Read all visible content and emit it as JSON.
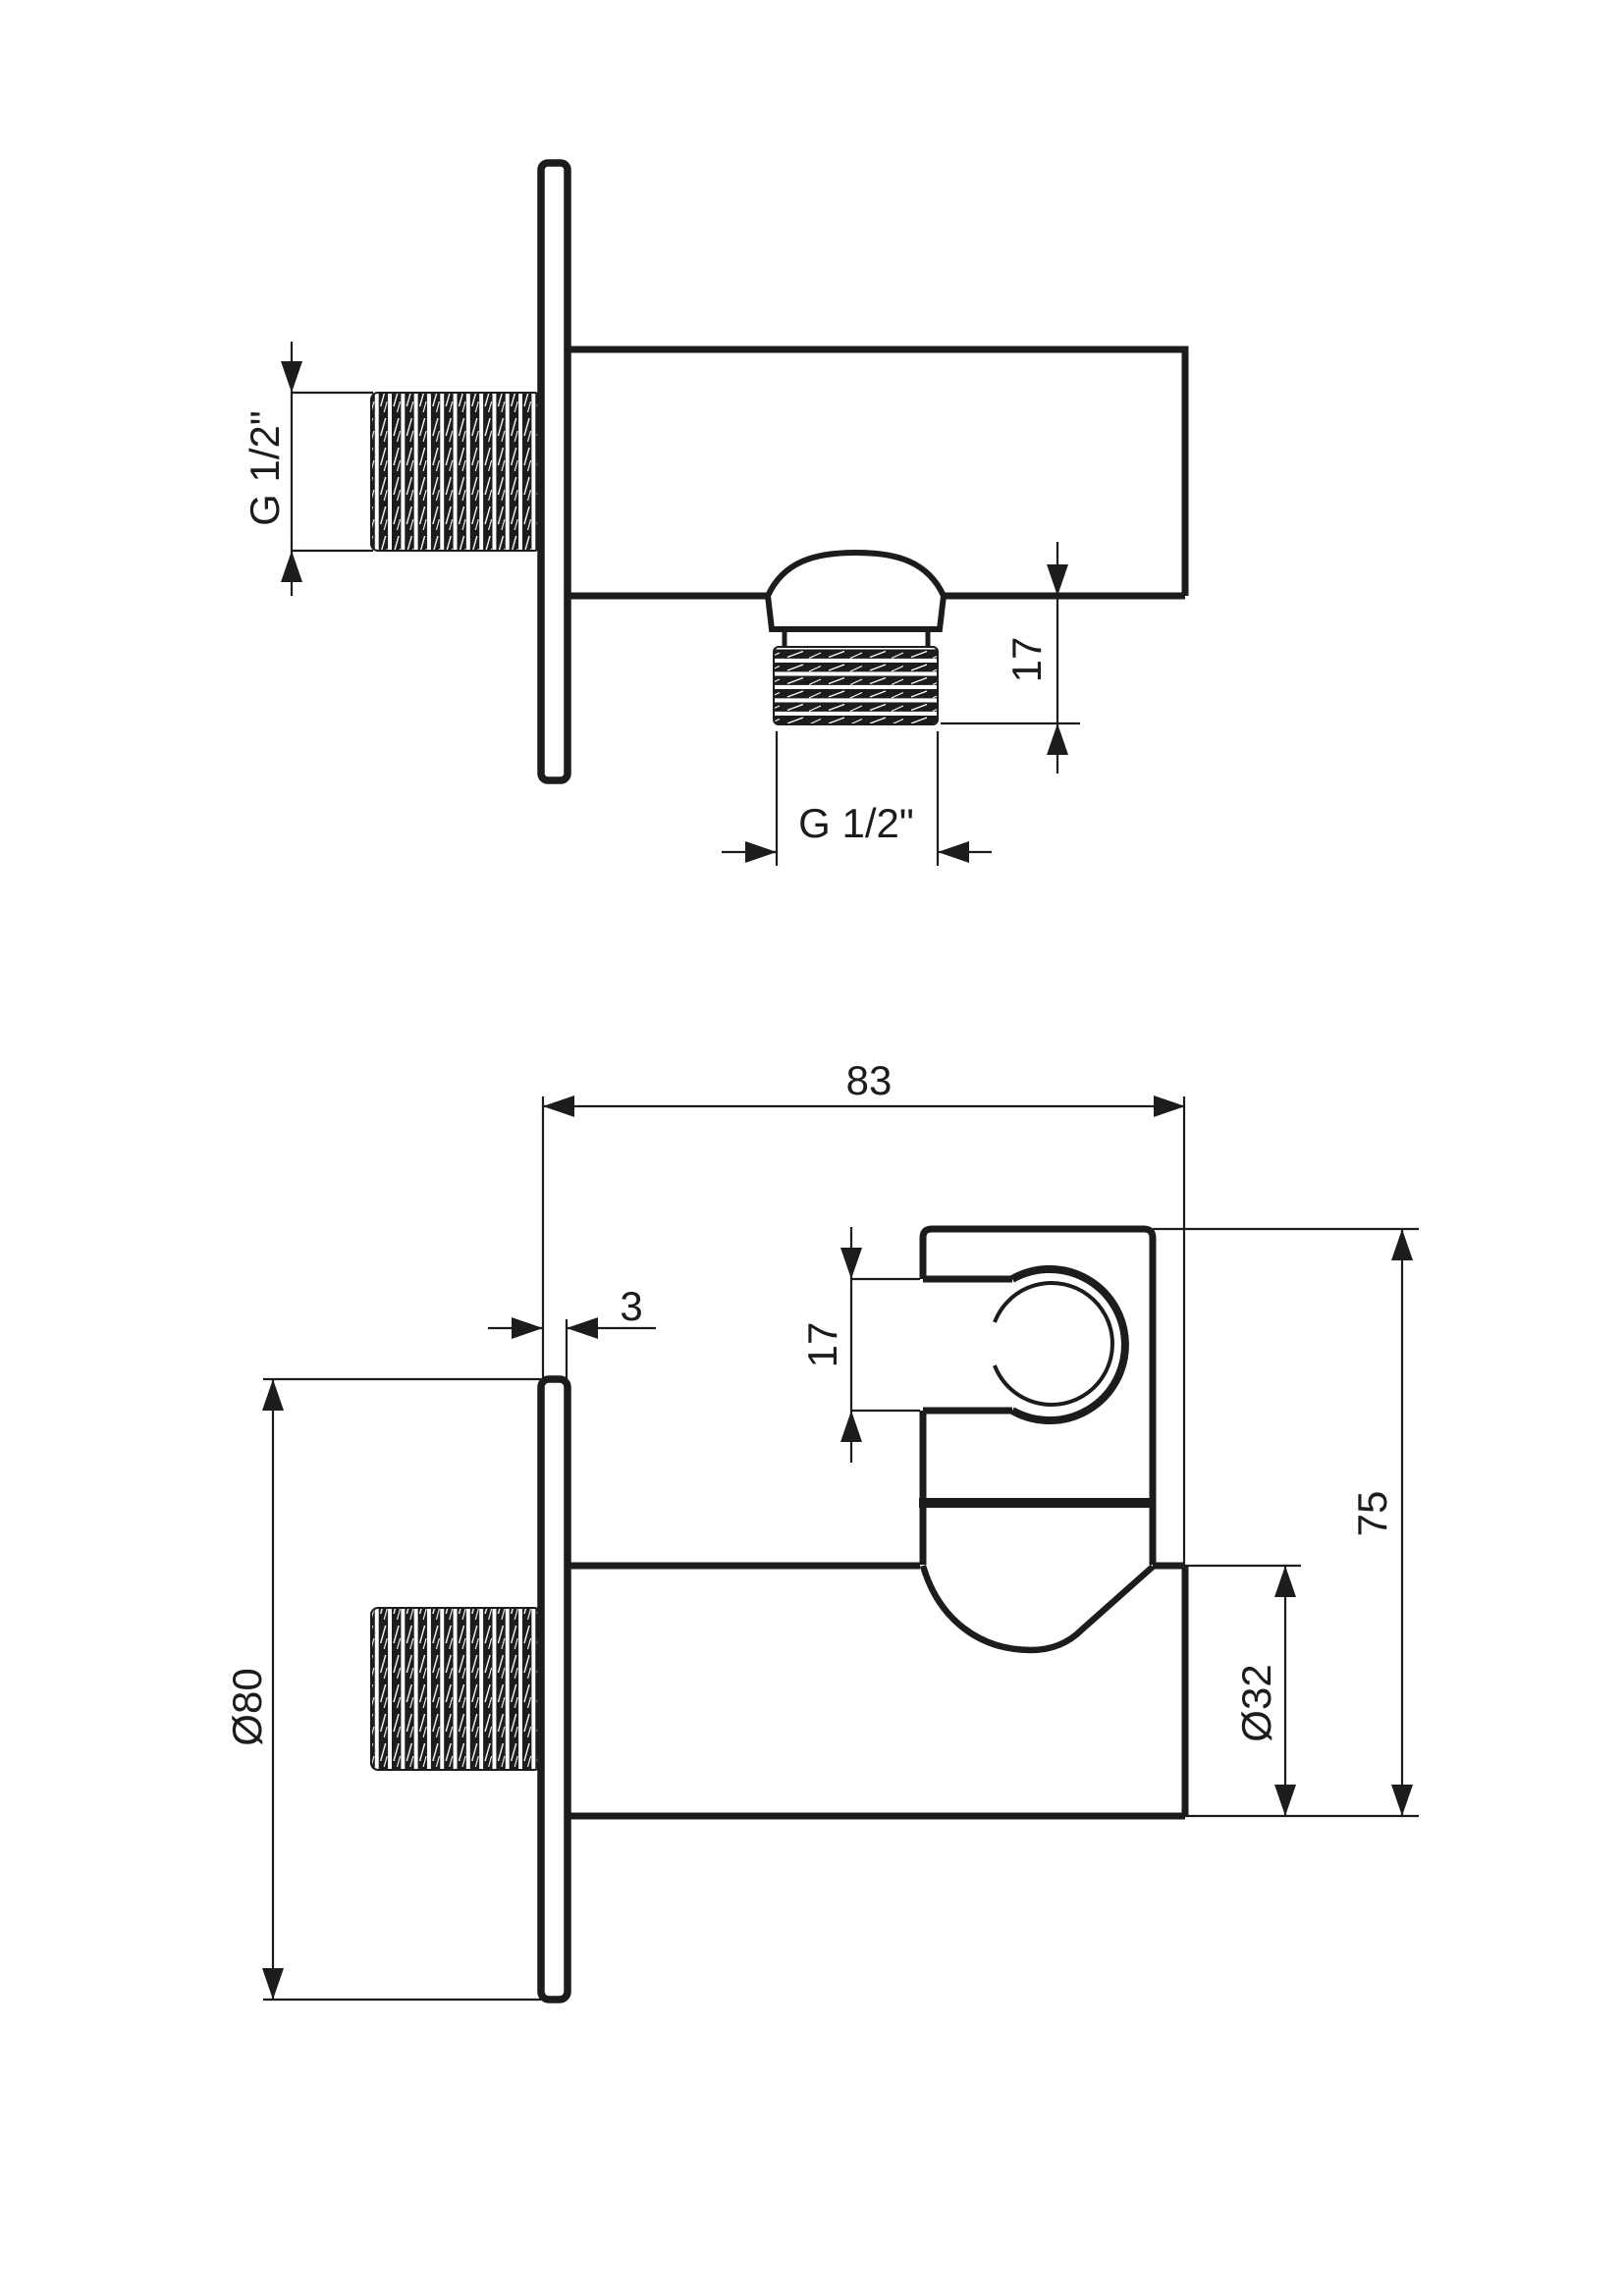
{
  "drawing": {
    "title": "angle-valve-with-shower-holder-technical-drawing",
    "background_color": "#ffffff",
    "line_color": "#1c1c1c",
    "views": {
      "top_view": {
        "name": "side-view-wall-outlet-elbow",
        "labels": {
          "inlet_thread": "G 1/2\"",
          "outlet_thread": "G 1/2\"",
          "outlet_thread_length": "17"
        }
      },
      "bottom_view": {
        "name": "side-view-with-handshower-holder",
        "labels": {
          "overall_depth": "83",
          "plate_thickness": "3",
          "holder_slot_width": "17",
          "overall_height": "75",
          "plate_diameter": "Ø80",
          "body_diameter": "Ø32"
        }
      }
    }
  }
}
